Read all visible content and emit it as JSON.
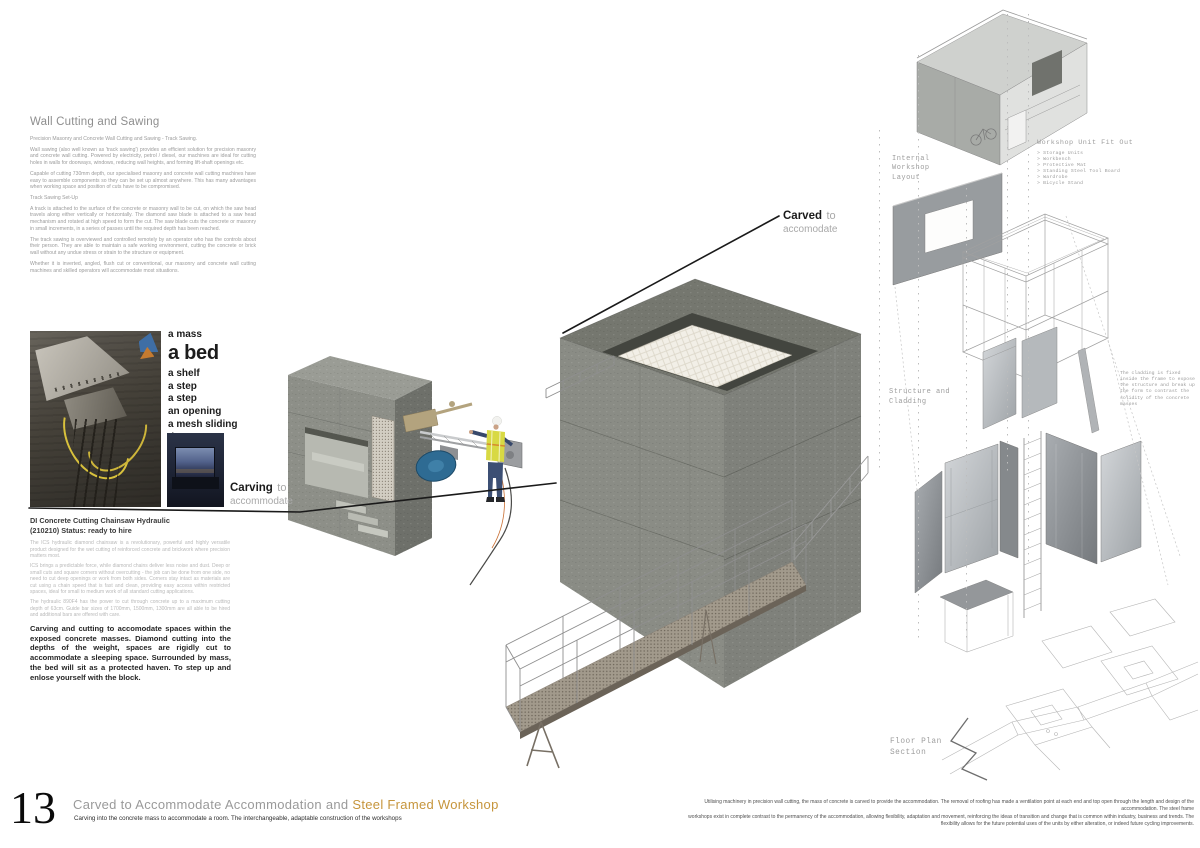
{
  "colors": {
    "accent_orange": "#c6953c",
    "blade_blue": "#2e6b93",
    "hivis_yellow": "#d8d943"
  },
  "left": {
    "title": "Wall Cutting and Sawing",
    "paragraphs": [
      "Precision Masonry and Concrete Wall Cutting and Sawing - Track Sawing.",
      "Wall sawing (also well known as 'track sawing') provides an efficient solution for precision masonry and concrete wall cutting. Powered by electricity, petrol / diesel, our machines are ideal for cutting holes in walls for doorways, windows, reducing wall heights, and forming lift-shaft openings etc.",
      "Capable of cutting 730mm depth, our specialised masonry and concrete wall cutting machines have easy to assemble components so they can be set up almost anywhere. This has many advantages when working space and position of cuts have to be compromised.",
      "Track Sawing Set-Up",
      "A track is attached to the surface of the concrete or masonry wall to be cut, on which the saw head travels along either vertically or horizontally. The diamond saw blade is attached to a saw head mechanism and rotated at high speed to form the cut. The saw blade cuts the concrete or masonry in small increments, in a series of passes until the required depth has been reached.",
      "The track sawing is overviewed and controlled remotely by an operator who has the controls about their person. They are able to maintain a safe working environment, cutting the concrete or brick wall without any undue stress or strain to the structure or equipment.",
      "Whether it is inverted, angled, flush cut or conventional, our masonry and concrete wall cutting machines and skilled operators will accommodate most situations."
    ],
    "carve_words": [
      "a mass",
      "a bed",
      "a shelf",
      "a step",
      "a step",
      "an opening",
      "a mesh sliding door"
    ],
    "carving_label": {
      "bold": "Carving",
      "gray": "to",
      "line2": "accommodate"
    },
    "hire_title_1": "DI Concrete Cutting Chainsaw Hydraulic",
    "hire_title_2": "(210210) Status: ready to hire",
    "hire_paragraphs": [
      "The ICS hydraulic diamond chainsaw is a revolutionary, powerful and highly versatile product designed for the wet cutting of reinforced concrete and brickwork where precision matters most.",
      "ICS brings a predictable force, while diamond chains deliver less noise and dust. Deep or small cuts and square corners without overcutting - the job can be done from one side, no need to cut deep openings or work from both sides. Corners stay intact as materials are cut using a chain speed that is fast and clean, providing easy access within restricted spaces, ideal for small to medium work of all standard cutting applications.",
      "The hydraulic 890F4 has the power to cut through concrete up to a maximum cutting depth of 63cm. Guide bar sizes of 1700mm, 1500mm, 1300mm are all able to be hired and additional bars are offered with care."
    ],
    "hire_bold": "Carving and cutting to accomodate spaces within the exposed concrete masses. Diamond cutting into the depths of the weight, spaces are rigidly cut to accommodate a sleeping space. Surrounded by mass, the bed will sit as a protected haven. To step up and enlose yourself with the block."
  },
  "annotations": {
    "carved_label": {
      "bold": "Carved",
      "gray": "to",
      "line2": "accomodate"
    }
  },
  "right": {
    "internal_label": "Internal\nWorkshop\nLayout",
    "fitout_title": "Workshop Unit Fit Out",
    "fitout_items": [
      "> Storage Units",
      "> Workbench",
      "> Protective Mat",
      "> Standing Steel Tool Board",
      "> Wardrobe",
      "> Bicycle Stand"
    ],
    "structure_label": "Structure and\nCladding",
    "cladding_note": "The cladding is fixed inside the frame to expose the structure and break up the form to contrast the solidity of the concrete masses",
    "floorplan_label": "Floor Plan\nSection"
  },
  "footer": {
    "page_number": "13",
    "title_gray": "Carved to Accommodate Accommodation and ",
    "title_accent": "Steel Framed Workshop",
    "subtitle": "Carving into the concrete mass to accommodate a room. The interchangeable, adaptable construction of the workshops",
    "right_text": "Utilising machinery in precision wall cutting, the mass of concrete is carved to provide the accommodation. The removal of roofing has made a ventilation point at each end and top open through the length and design of the accommodation. The steel frame\nworkshops exist in complete contrast to the permanency of the accommodation, allowing flexibility, adaptation and movement, reinforcing the ideas of transition and change that is common within industry, business and trends. The\nflexibility allows for the future potential uses of the units by either alteration, or indeed future cycling improvements."
  }
}
